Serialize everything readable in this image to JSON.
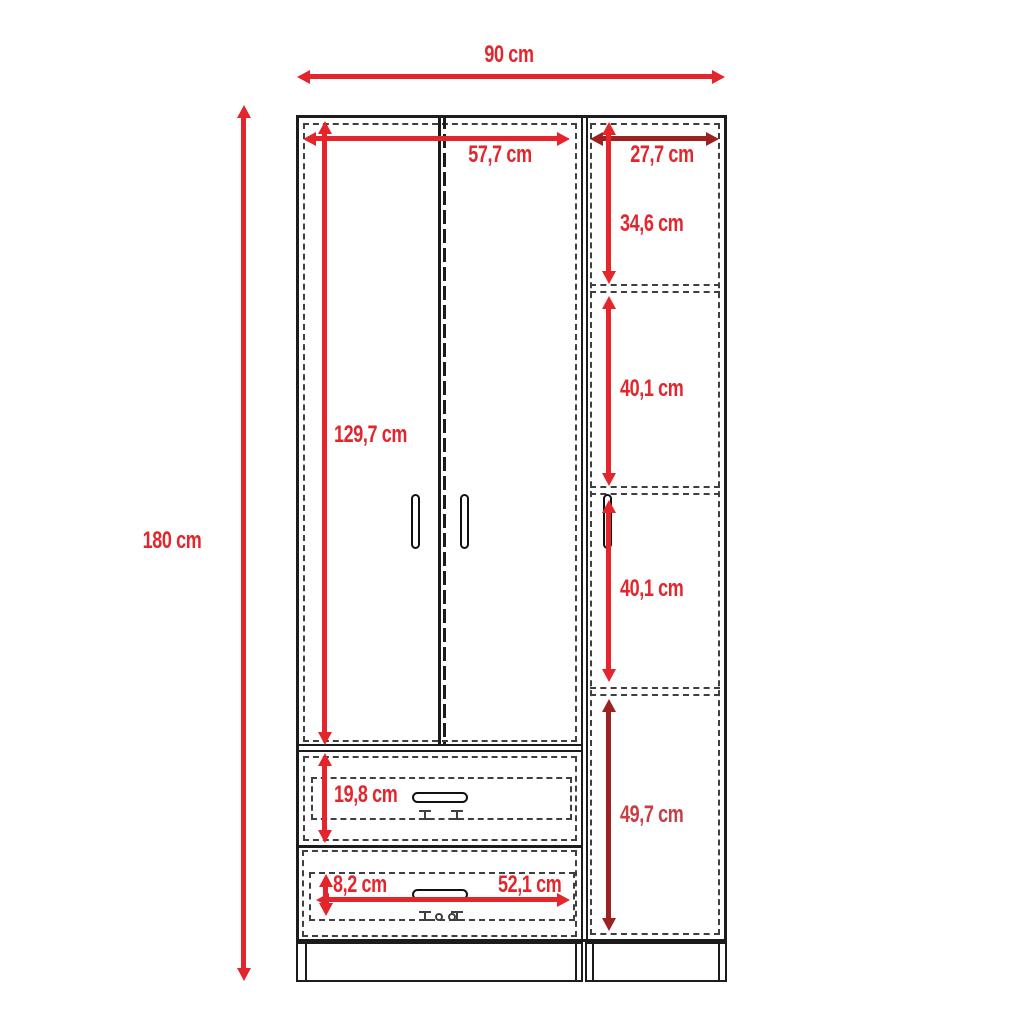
{
  "meta": {
    "type": "furniture-dimension-diagram",
    "subject": "three-door wardrobe with two drawers and side shelf column"
  },
  "colors": {
    "dimension_red": "#e4252c",
    "dimension_dark_red": "#9b2123",
    "dimension_muted_red": "#c83e44",
    "line_black": "#1c1c1c",
    "dash_gray": "#3f3f3f",
    "background": "#ffffff"
  },
  "labels": {
    "overall_width": "90 cm",
    "overall_height": "180 cm",
    "doors_width": "57,7 cm",
    "side_width": "27,7 cm",
    "doors_height": "129,7 cm",
    "side_top_section": "34,6 cm",
    "side_mid_section_1": "40,1 cm",
    "side_mid_section_2": "40,1 cm",
    "side_bottom_section": "49,7 cm",
    "drawer_1_height": "19,8 cm",
    "drawer_2_height": "8,2 cm",
    "drawer_width": "52,1 cm"
  }
}
